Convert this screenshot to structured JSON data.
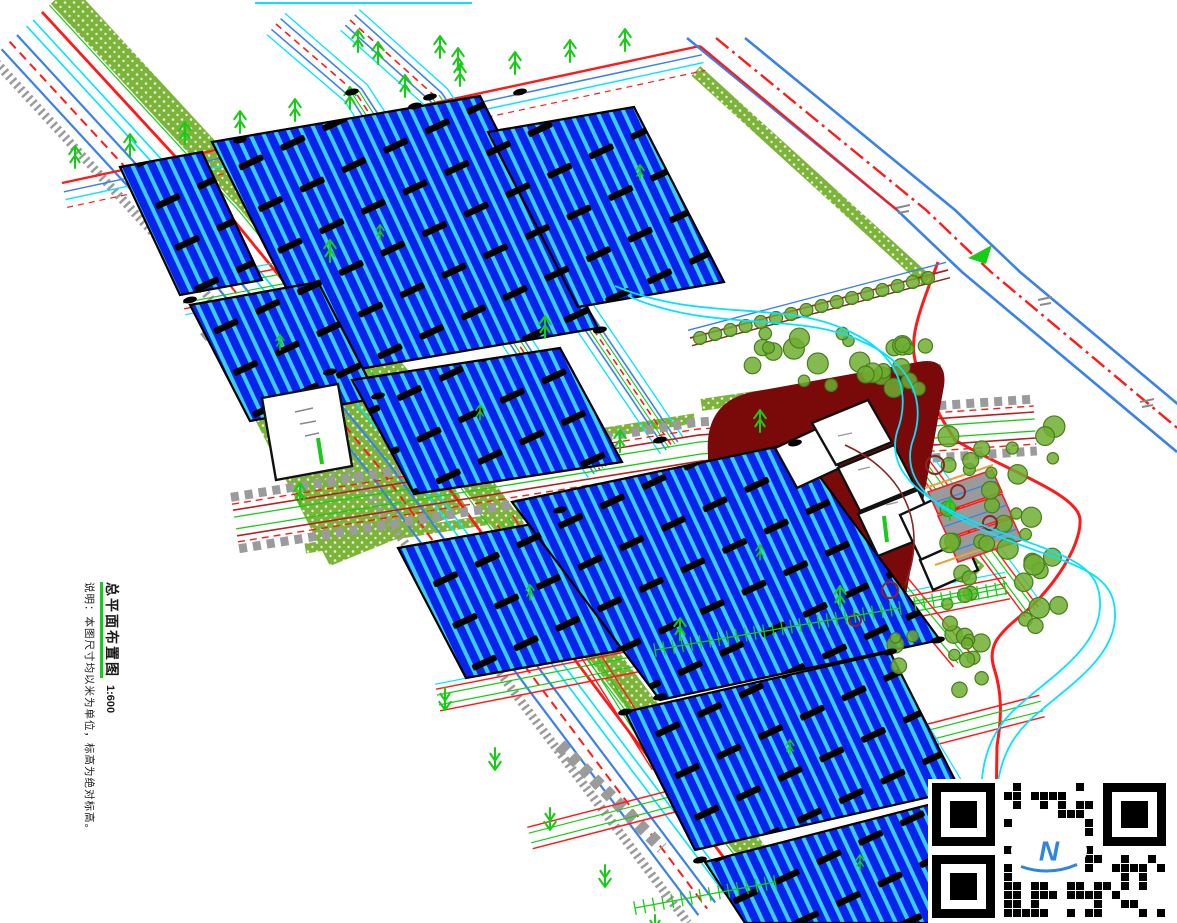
{
  "caption": {
    "title": "总平面布置图",
    "scale": "1:600",
    "note": "说明：本图尺寸均以米为单位，标高为绝对标高。"
  },
  "qr": {
    "logo_text": "N"
  },
  "colors": {
    "panel_blue": "#0823EC",
    "panel_stripe": "#38CCF2",
    "road_blue": "#3B82E8",
    "cyan": "#00E5FF",
    "red": "#FF1A1A",
    "dark_red": "#B22222",
    "brown": "#8B2525",
    "maroon": "#7A0A0A",
    "grass": "#7CB43A",
    "tree_green": "#6FAE30",
    "tree_outline": "#457F1C",
    "bright_green": "#17CC17",
    "orange": "#E8A33D",
    "gray": "#9B9B9B",
    "black": "#000000",
    "white": "#FFFFFF",
    "qr_logo_blue": "#2E86DE"
  }
}
